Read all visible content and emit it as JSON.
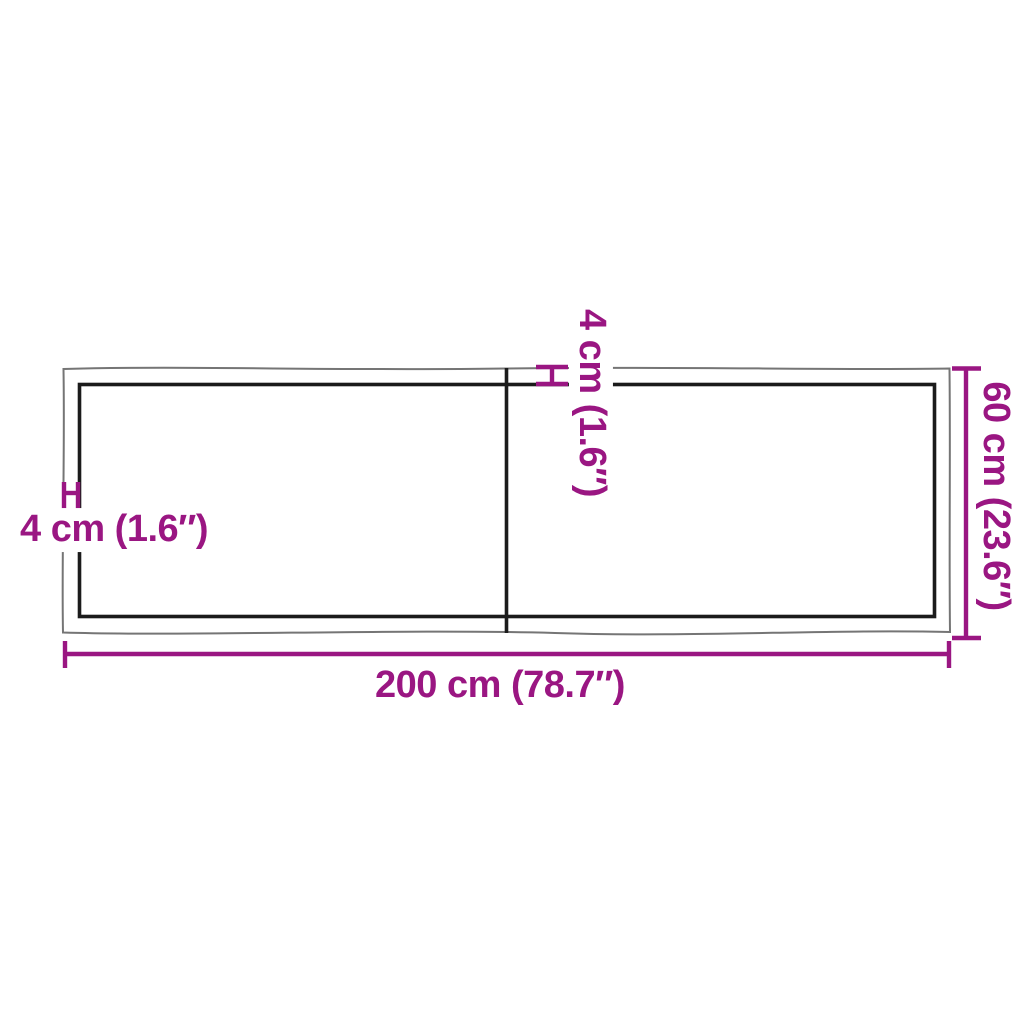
{
  "diagram": {
    "kind": "product-dimension-diagram",
    "subject": "wooden board / table top, top view with live edge, two panels with center seam",
    "colors": {
      "dimension_accent": "#9A1682",
      "outer_edge_line": "#757575",
      "inner_edge_line": "#1B1B1B",
      "background": "#FFFFFF"
    },
    "labels": {
      "width": "200 cm (78.7″)",
      "depth": "60 cm (23.6″)",
      "edge_top": "4 cm (1.6″)",
      "edge_left": "4 cm (1.6″)"
    },
    "values": {
      "width_cm": 200,
      "width_in": 78.7,
      "depth_cm": 60,
      "depth_in": 23.6,
      "edge_cm": 4,
      "edge_in": 1.6
    }
  }
}
